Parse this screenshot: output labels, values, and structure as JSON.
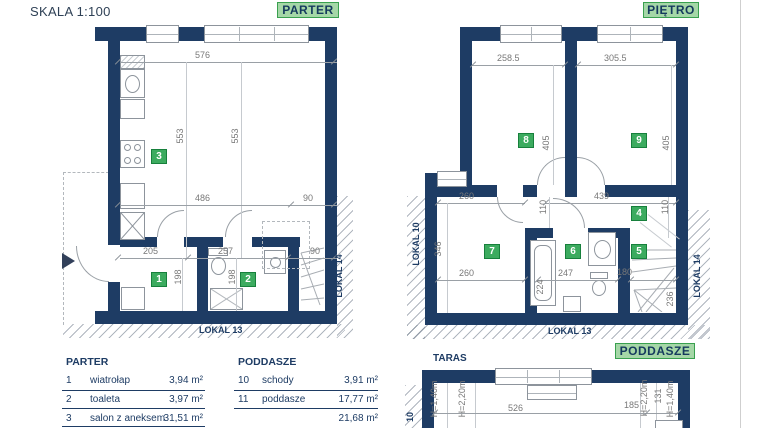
{
  "colors": {
    "wall_navy": "#1e3c64",
    "badge_green": "#3cab5f",
    "badge_green_border": "#17803c",
    "header_badge_bg": "#a5d7a7",
    "header_badge_border": "#39a04f",
    "header_badge_text": "#153a5e",
    "dim_gray": "#787878"
  },
  "header": {
    "scale_label": "SKALA 1:100",
    "parter_badge": "PARTER",
    "pietro_badge": "PIĘTRO",
    "poddasze_badge": "PODDASZE",
    "taras_label": "TARAS"
  },
  "parter": {
    "rooms": {
      "r1": "1",
      "r2": "2",
      "r3": "3"
    },
    "dims": {
      "top_width": "576",
      "height_left": "553",
      "height_right": "553",
      "mid_left": "486",
      "mid_right": "90",
      "low_left": "205",
      "low_mid": "257",
      "low_right": "90",
      "room1_height": "198",
      "room2_height": "198"
    },
    "labels": {
      "lokal13": "LOKAL 13",
      "lokal14": "LOKAL 14"
    }
  },
  "pietro": {
    "rooms": {
      "r4": "4",
      "r5": "5",
      "r6": "6",
      "r7": "7",
      "r8": "8",
      "r9": "9"
    },
    "dims": {
      "room8_width": "258.5",
      "room9_width": "305.5",
      "room8_height": "405",
      "room9_height": "405",
      "hall_left": "260",
      "hall_right": "439",
      "hall_height_left": "110",
      "hall_height_right": "110",
      "room7_height": "346",
      "room7_width": "260",
      "bath_width": "247",
      "stair_width": "180",
      "bath_height": "224",
      "stair_height": "236"
    },
    "labels": {
      "lokal10": "LOKAL 10",
      "lokal13": "LOKAL 13",
      "lokal14": "LOKAL 14"
    }
  },
  "poddasze": {
    "dims": {
      "width_main": "526",
      "width_right": "185",
      "h140_left": "H=1,40m",
      "h220_left": "H=2,20m",
      "h220_right": "H=2,20m",
      "d131": "131",
      "h140_right": "H=1,40m"
    },
    "labels": {
      "lokal10_partial": "10"
    }
  },
  "legend_parter": {
    "title": "PARTER",
    "rows": [
      {
        "no": "1",
        "name": "wiatrołap",
        "area": "3,94 m²"
      },
      {
        "no": "2",
        "name": "toaleta",
        "area": "3,97 m²"
      },
      {
        "no": "3",
        "name": "salon z aneksem",
        "area": "31,51 m²"
      }
    ]
  },
  "legend_poddasze": {
    "title": "PODDASZE",
    "rows": [
      {
        "no": "10",
        "name": "schody",
        "area": "3,91 m²"
      },
      {
        "no": "11",
        "name": "poddasze",
        "area": "17,77 m²"
      }
    ],
    "total": "21,68 m²"
  }
}
